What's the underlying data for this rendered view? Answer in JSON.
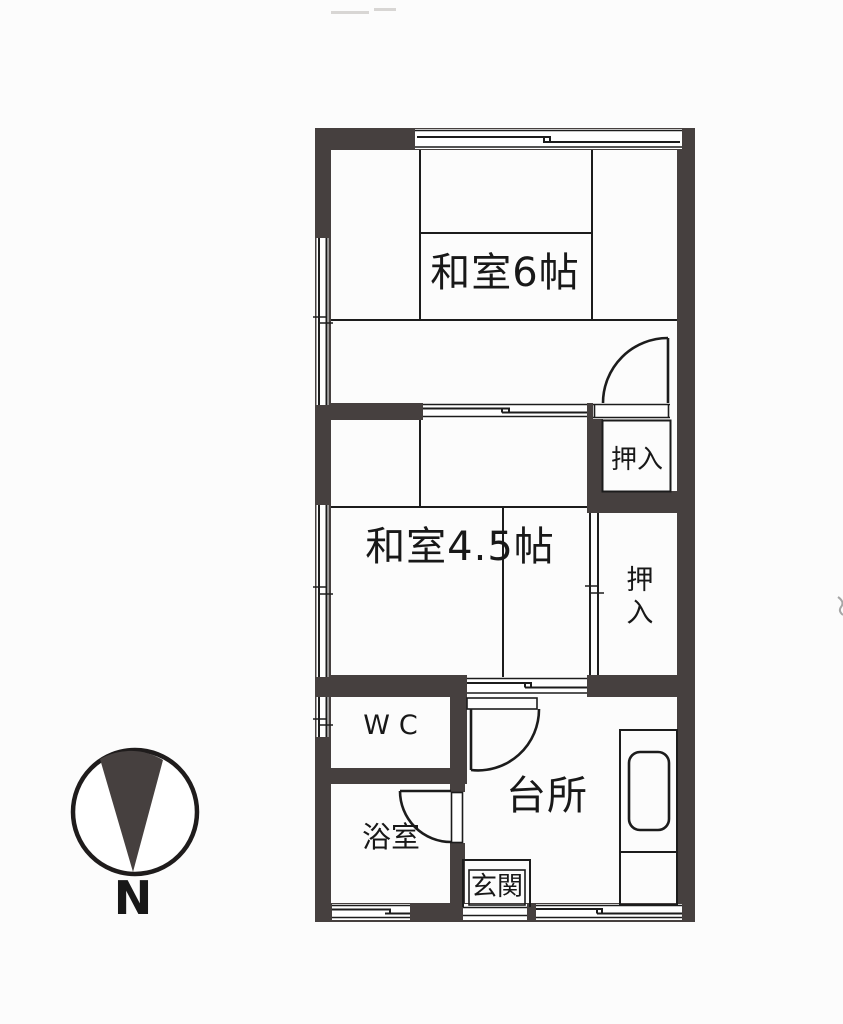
{
  "document": {
    "kind": "scanned apartment floor plan (Japan, 2K layout)",
    "orientation_note": "north arrow points toward bottom of drawing"
  },
  "labels": {
    "japanese_room_6": "和室6帖",
    "japanese_room_45": "和室4.5帖",
    "closet_upper": "押入",
    "closet_lower": "押入",
    "wc": "WC",
    "kitchen": "台所",
    "bathroom": "浴室",
    "entrance": "玄関",
    "compass_north": "N"
  },
  "colors": {
    "wall": "#46403f",
    "line": "#1c1c1c",
    "bg": "#fcfcfc"
  }
}
